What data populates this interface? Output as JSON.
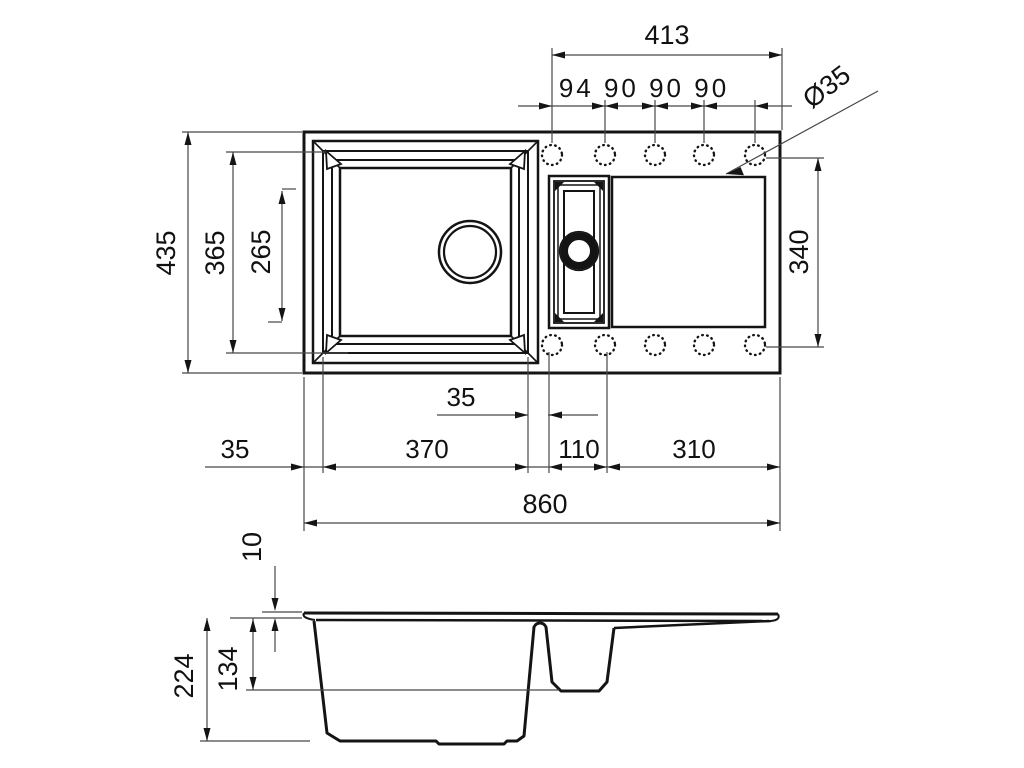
{
  "drawing": {
    "kind": "technical dimension drawing",
    "subject": "kitchen sink, one-and-a-half bowl with drainer",
    "views": [
      "top plan view",
      "front section view"
    ],
    "line_color": "#141414",
    "dim_line_color": "#474747"
  },
  "dims": {
    "top": {
      "total": "413",
      "spacing": "94 90 90 90",
      "hole_dia": "Ø35"
    },
    "left": {
      "overall": "435",
      "bowl_outer": "365",
      "bowl_inner": "265"
    },
    "right": {
      "span": "340"
    },
    "bottom": {
      "margin": "35",
      "main_bowl": "370",
      "gap": "35",
      "half_bowl": "110",
      "drainer": "310",
      "overall": "860"
    },
    "section": {
      "rim": "10",
      "half_depth": "134",
      "depth": "224"
    }
  }
}
